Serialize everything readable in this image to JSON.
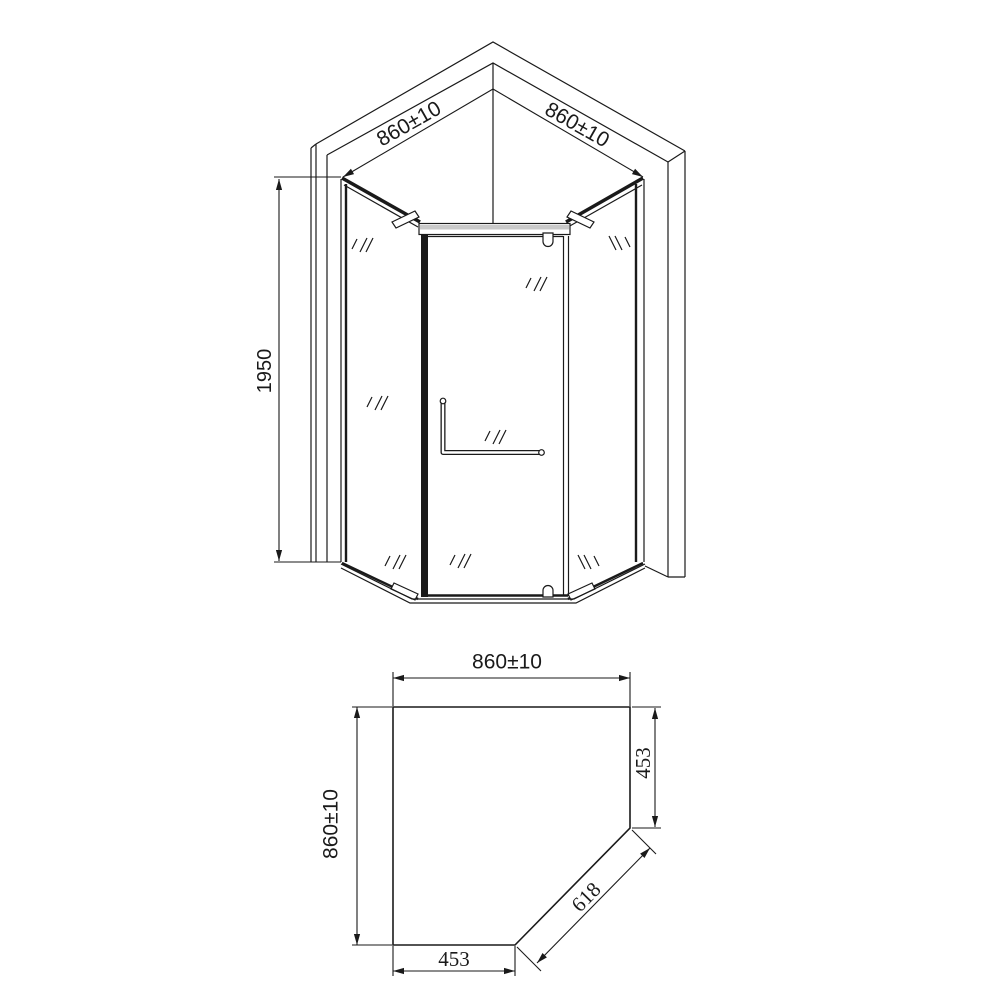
{
  "elevation": {
    "wall_left_dim": "860±10",
    "wall_right_dim": "860±10",
    "height_dim": "1950"
  },
  "plan": {
    "top_dim": "860±10",
    "left_dim": "860±10",
    "right_dim": "453",
    "diagonal_dim": "618",
    "bottom_dim": "453"
  },
  "colors": {
    "background": "#ffffff",
    "line": "#1a1a1a",
    "header_fill": "#c9c9c9"
  }
}
